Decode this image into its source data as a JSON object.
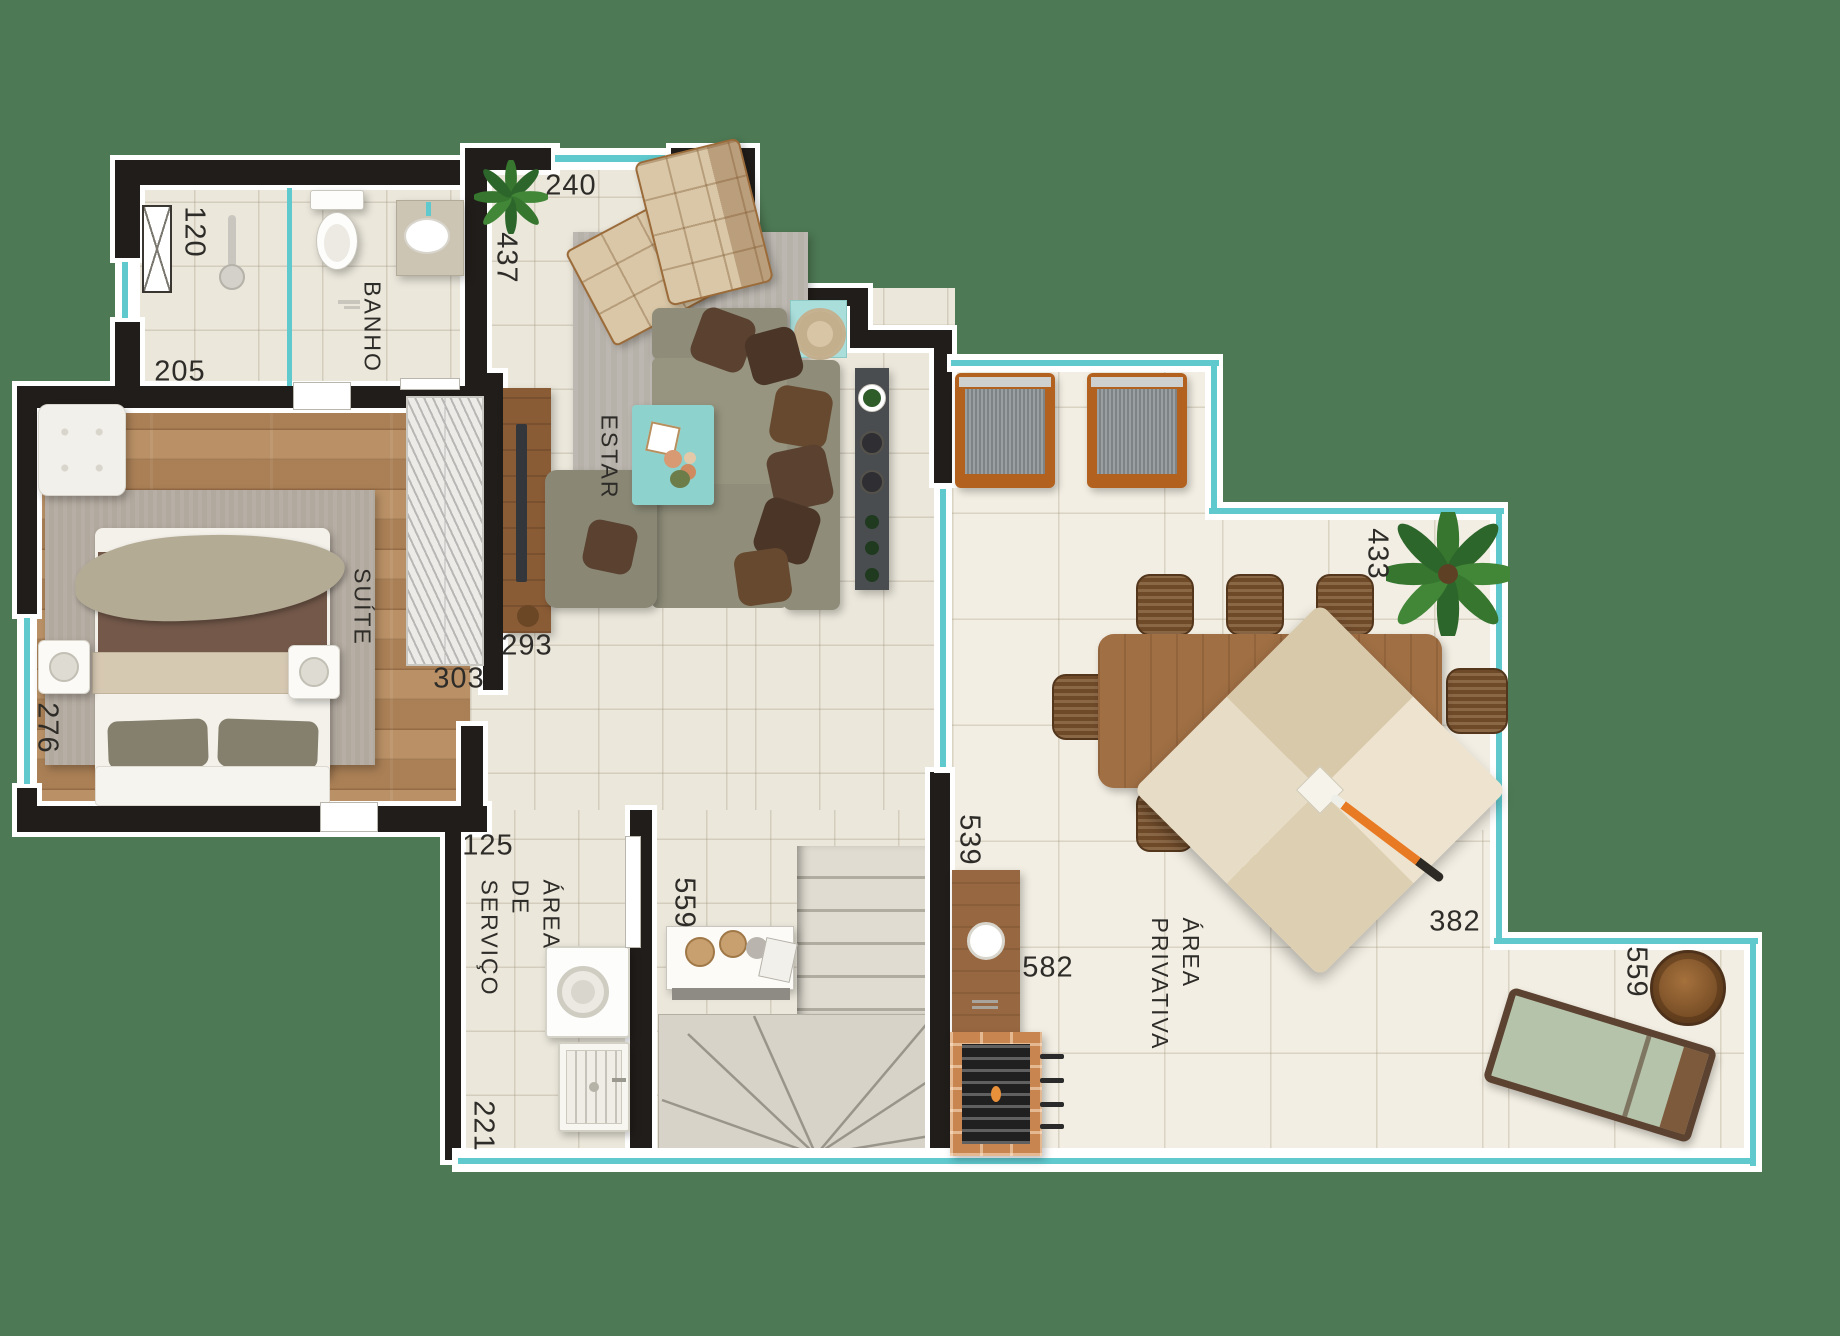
{
  "colors": {
    "background_green": "#4d7954",
    "wall_black": "#211d1a",
    "glass_teal": "#5fc9ce",
    "accent_teal": "#8ed2cd"
  },
  "rooms": {
    "bathroom": "BANHO",
    "suite": "SUÍTE",
    "living": "ESTAR",
    "service": [
      "ÁREA",
      "DE",
      "SERVIÇO"
    ],
    "private": [
      "ÁREA",
      "PRIVATIVA"
    ]
  },
  "dimensions": {
    "shaft": "120",
    "bathroom": "205",
    "window": "240",
    "living": "437",
    "tv_wall": "293",
    "wardrobe_wall": "303",
    "suite_width": "276",
    "service_top": "125",
    "hall": "559",
    "terrace_west": "539",
    "terrace_north": "433",
    "terrace_east": "382",
    "terrace_nook": "559",
    "terrace_south": "582",
    "service_side": "221"
  }
}
